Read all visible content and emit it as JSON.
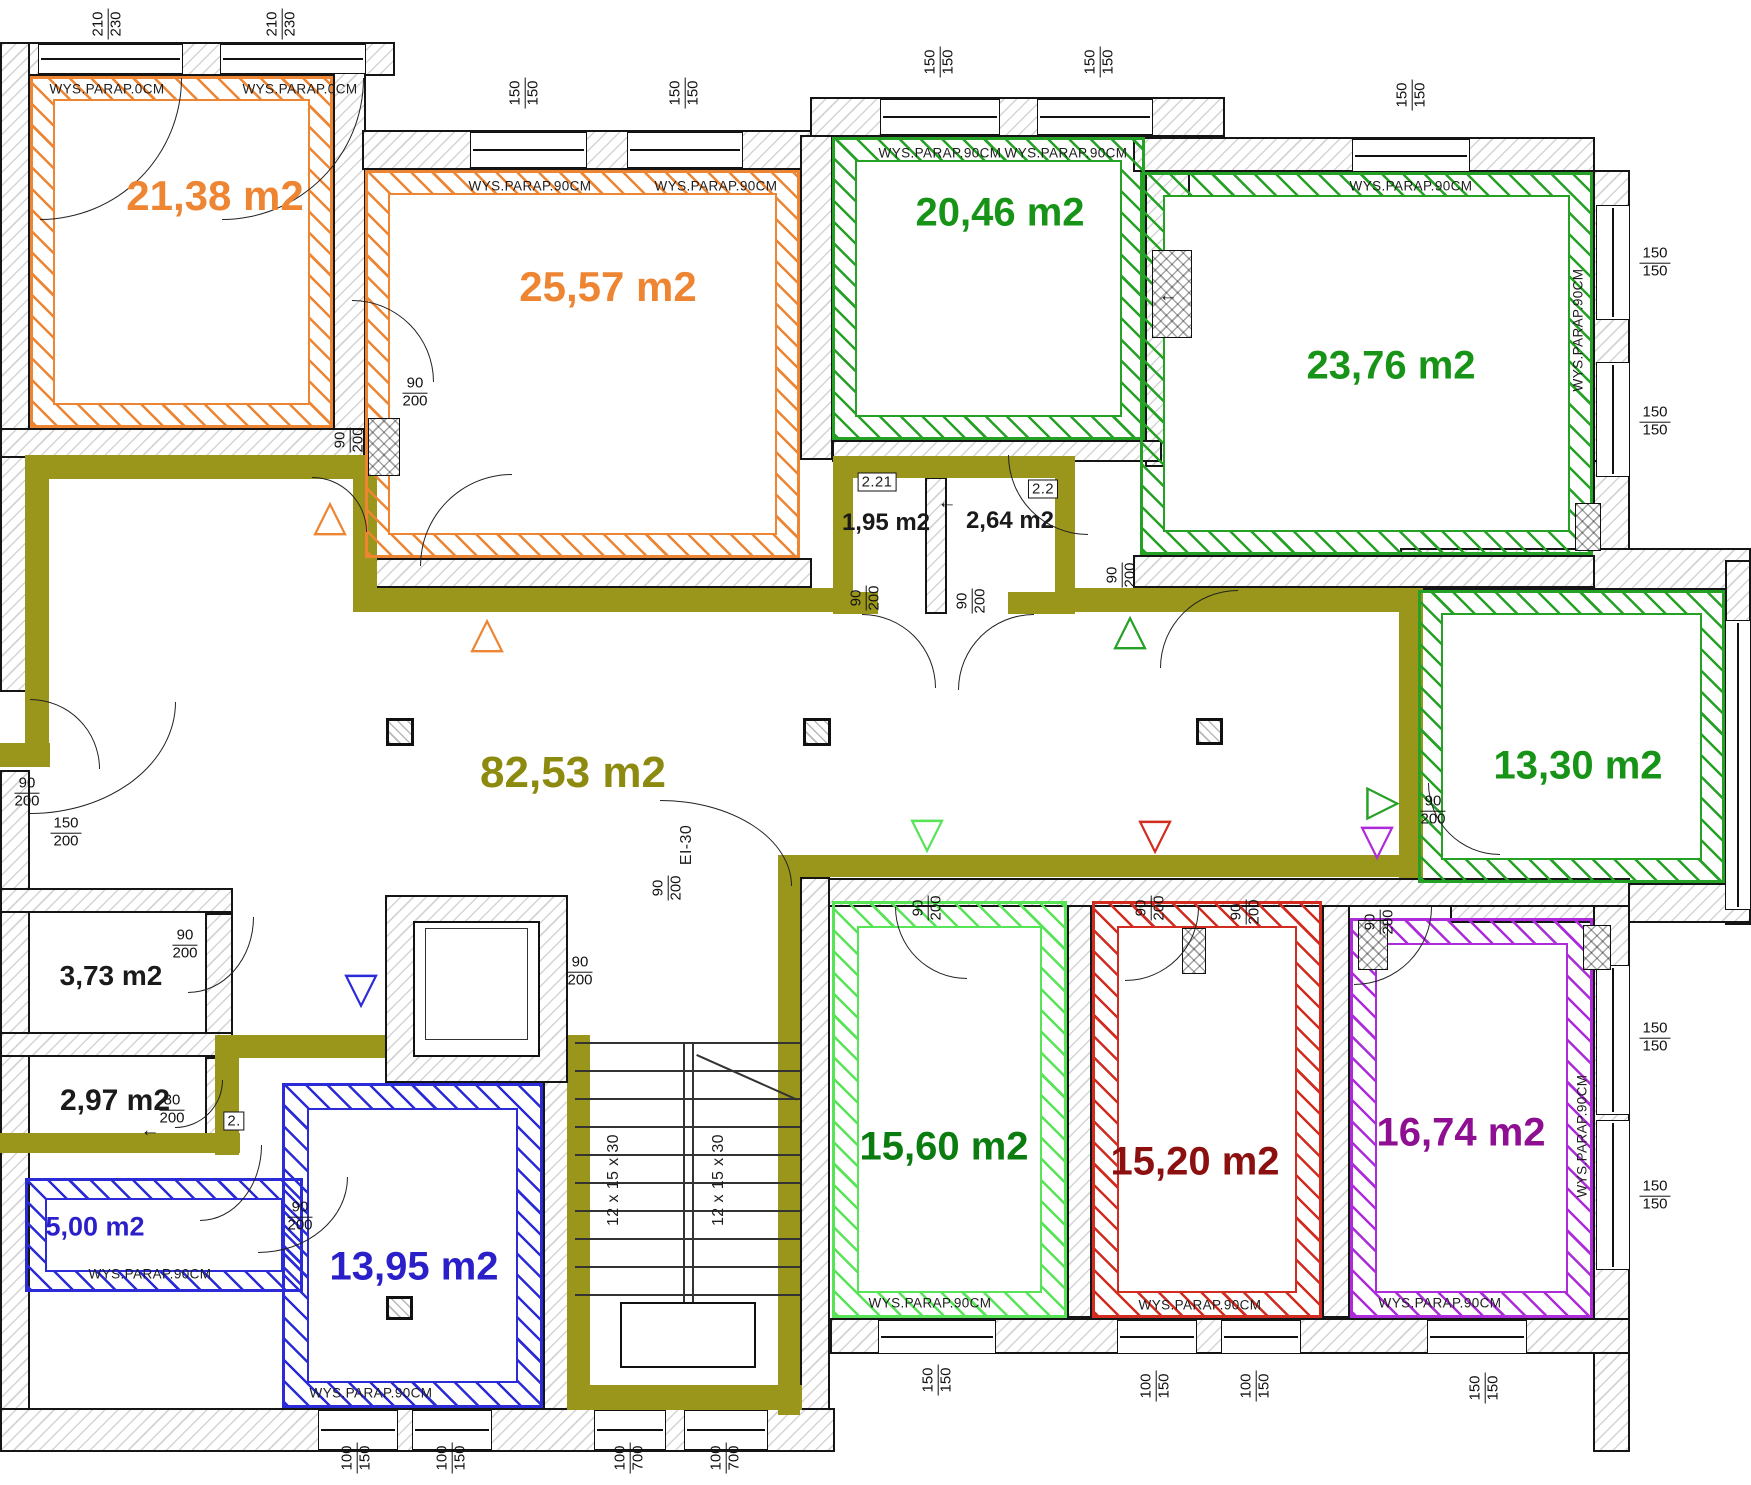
{
  "drawing": {
    "type": "architectural floor plan",
    "units": "m2 / cm"
  },
  "colors": {
    "orange": "#ED8533",
    "green": "#25A125",
    "green_text": "#179417",
    "olive": "#9A951B",
    "olive_text": "#8D8A10",
    "lgreen": "#57E457",
    "dgreen": "#0B7D10",
    "red": "#D22B20",
    "dred": "#8C1010",
    "purple": "#AD2BDB",
    "dpurple": "#8E0F92",
    "blue": "#2B2BD8",
    "blue_text": "#2A1FC9",
    "ink": "#1A1A1A"
  },
  "area_labels": [
    {
      "text": "21,38 m2",
      "x": 215,
      "y": 196,
      "s": 42,
      "c": "#ED8533"
    },
    {
      "text": "25,57 m2",
      "x": 608,
      "y": 287,
      "s": 42,
      "c": "#ED8533"
    },
    {
      "text": "20,46 m2",
      "x": 1000,
      "y": 213,
      "s": 40,
      "c": "#179417"
    },
    {
      "text": "23,76 m2",
      "x": 1391,
      "y": 366,
      "s": 40,
      "c": "#179417"
    },
    {
      "text": "13,30 m2",
      "x": 1578,
      "y": 766,
      "s": 40,
      "c": "#179417"
    },
    {
      "text": "82,53 m2",
      "x": 573,
      "y": 773,
      "s": 44,
      "c": "#8D8A10"
    },
    {
      "text": "1,95 m2",
      "x": 886,
      "y": 523,
      "s": 24,
      "c": "#1A1A1A"
    },
    {
      "text": "2,64 m2",
      "x": 1010,
      "y": 521,
      "s": 24,
      "c": "#1A1A1A"
    },
    {
      "text": "3,73 m2",
      "x": 111,
      "y": 976,
      "s": 28,
      "c": "#1A1A1A"
    },
    {
      "text": "2,97 m2",
      "x": 115,
      "y": 1101,
      "s": 30,
      "c": "#1A1A1A"
    },
    {
      "text": "5,00 m2",
      "x": 95,
      "y": 1227,
      "s": 27,
      "c": "#2A1FC9"
    },
    {
      "text": "13,95 m2",
      "x": 414,
      "y": 1267,
      "s": 40,
      "c": "#2A1FC9"
    },
    {
      "text": "15,60 m2",
      "x": 944,
      "y": 1147,
      "s": 40,
      "c": "#0B7D10"
    },
    {
      "text": "15,20 m2",
      "x": 1195,
      "y": 1162,
      "s": 40,
      "c": "#8C1010"
    },
    {
      "text": "16,74 m2",
      "x": 1461,
      "y": 1133,
      "s": 40,
      "c": "#8E0F92"
    }
  ],
  "rooms": [
    {
      "n": "room-21-38",
      "x": 30,
      "y": 76,
      "w": 303,
      "h": 352,
      "c": "#ED8533",
      "b": 20
    },
    {
      "n": "room-25-57",
      "x": 365,
      "y": 170,
      "w": 435,
      "h": 388,
      "c": "#ED8533",
      "b": 20
    },
    {
      "n": "room-20-46",
      "x": 832,
      "y": 137,
      "w": 313,
      "h": 303,
      "c": "#25A125",
      "b": 20
    },
    {
      "n": "room-23-76",
      "x": 1140,
      "y": 172,
      "w": 453,
      "h": 383,
      "c": "#25A125",
      "b": 20
    },
    {
      "n": "room-13-30",
      "x": 1418,
      "y": 590,
      "w": 307,
      "h": 293,
      "c": "#25A125",
      "b": 20
    },
    {
      "n": "room-15-60",
      "x": 832,
      "y": 901,
      "w": 235,
      "h": 417,
      "c": "#57E457",
      "b": 22
    },
    {
      "n": "room-15-20",
      "x": 1092,
      "y": 901,
      "w": 230,
      "h": 417,
      "c": "#D22B20",
      "b": 22
    },
    {
      "n": "room-16-74",
      "x": 1350,
      "y": 918,
      "w": 243,
      "h": 400,
      "c": "#AD2BDB",
      "b": 22
    },
    {
      "n": "room-13-95",
      "x": 282,
      "y": 1083,
      "w": 261,
      "h": 325,
      "c": "#2B2BD8",
      "b": 22
    },
    {
      "n": "room-5-00",
      "x": 25,
      "y": 1178,
      "w": 278,
      "h": 114,
      "c": "#2B2BD8",
      "b": 17
    }
  ],
  "walls": [
    [
      0,
      42,
      395,
      34
    ],
    [
      0,
      42,
      30,
      650
    ],
    [
      0,
      770,
      30,
      682
    ],
    [
      333,
      42,
      33,
      395
    ],
    [
      0,
      428,
      365,
      30
    ],
    [
      362,
      130,
      450,
      40
    ],
    [
      800,
      135,
      33,
      325
    ],
    [
      810,
      97,
      415,
      40
    ],
    [
      1145,
      137,
      45,
      330
    ],
    [
      1133,
      137,
      462,
      35
    ],
    [
      1593,
      170,
      37,
      295
    ],
    [
      1593,
      460,
      37,
      95
    ],
    [
      1400,
      548,
      351,
      42
    ],
    [
      1725,
      560,
      26,
      365
    ],
    [
      1450,
      883,
      301,
      40
    ],
    [
      1593,
      905,
      37,
      547
    ],
    [
      0,
      1408,
      835,
      44
    ],
    [
      830,
      1318,
      800,
      36
    ],
    [
      812,
      878,
      818,
      29
    ],
    [
      0,
      888,
      233,
      25
    ],
    [
      205,
      913,
      28,
      122
    ],
    [
      0,
      1032,
      233,
      25
    ],
    [
      205,
      1057,
      28,
      78
    ],
    [
      543,
      1057,
      28,
      353
    ],
    [
      800,
      877,
      30,
      533
    ],
    [
      1067,
      905,
      25,
      413
    ],
    [
      1322,
      905,
      28,
      413
    ],
    [
      362,
      558,
      450,
      30
    ],
    [
      832,
      440,
      330,
      22
    ],
    [
      1133,
      555,
      462,
      33
    ],
    [
      925,
      477,
      22,
      137
    ],
    [
      385,
      895,
      183,
      188
    ]
  ],
  "olive_segments": [
    [
      25,
      455,
      352,
      24
    ],
    [
      25,
      455,
      24,
      300
    ],
    [
      0,
      743,
      50,
      24
    ],
    [
      353,
      478,
      24,
      114
    ],
    [
      353,
      588,
      482,
      24
    ],
    [
      833,
      456,
      242,
      22
    ],
    [
      833,
      456,
      20,
      158
    ],
    [
      1055,
      456,
      20,
      158
    ],
    [
      833,
      592,
      45,
      22
    ],
    [
      1008,
      592,
      67,
      22
    ],
    [
      1075,
      588,
      348,
      24
    ],
    [
      1399,
      588,
      24,
      290
    ],
    [
      800,
      855,
      623,
      22
    ],
    [
      778,
      855,
      22,
      560
    ],
    [
      567,
      1035,
      23,
      372
    ],
    [
      567,
      1385,
      235,
      25
    ],
    [
      237,
      1035,
      353,
      23
    ],
    [
      215,
      1035,
      24,
      120
    ],
    [
      0,
      1133,
      240,
      20
    ]
  ],
  "windows": [
    {
      "x": 38,
      "y": 44,
      "w": 145,
      "h": 30,
      "o": "h"
    },
    {
      "x": 220,
      "y": 44,
      "w": 146,
      "h": 30,
      "o": "h"
    },
    {
      "x": 470,
      "y": 132,
      "w": 117,
      "h": 36,
      "o": "h"
    },
    {
      "x": 627,
      "y": 132,
      "w": 116,
      "h": 36,
      "o": "h"
    },
    {
      "x": 880,
      "y": 99,
      "w": 120,
      "h": 36,
      "o": "h"
    },
    {
      "x": 1037,
      "y": 99,
      "w": 116,
      "h": 36,
      "o": "h"
    },
    {
      "x": 1352,
      "y": 139,
      "w": 118,
      "h": 33,
      "o": "h"
    },
    {
      "x": 1596,
      "y": 205,
      "w": 34,
      "h": 115,
      "o": "v"
    },
    {
      "x": 1596,
      "y": 362,
      "w": 34,
      "h": 115,
      "o": "v"
    },
    {
      "x": 1725,
      "y": 620,
      "w": 26,
      "h": 290,
      "o": "v"
    },
    {
      "x": 1596,
      "y": 965,
      "w": 34,
      "h": 150,
      "o": "v"
    },
    {
      "x": 1596,
      "y": 1120,
      "w": 34,
      "h": 150,
      "o": "v"
    },
    {
      "x": 318,
      "y": 1410,
      "w": 80,
      "h": 40,
      "o": "h"
    },
    {
      "x": 412,
      "y": 1410,
      "w": 80,
      "h": 40,
      "o": "h"
    },
    {
      "x": 594,
      "y": 1410,
      "w": 72,
      "h": 40,
      "o": "h"
    },
    {
      "x": 684,
      "y": 1410,
      "w": 84,
      "h": 40,
      "o": "h"
    },
    {
      "x": 878,
      "y": 1320,
      "w": 118,
      "h": 34,
      "o": "h"
    },
    {
      "x": 1117,
      "y": 1320,
      "w": 80,
      "h": 34,
      "o": "h"
    },
    {
      "x": 1221,
      "y": 1320,
      "w": 80,
      "h": 34,
      "o": "h"
    },
    {
      "x": 1427,
      "y": 1320,
      "w": 100,
      "h": 34,
      "o": "h"
    }
  ],
  "dims": [
    {
      "a": "210",
      "b": "230",
      "x": 108,
      "y": 24,
      "rot": true
    },
    {
      "a": "210",
      "b": "230",
      "x": 282,
      "y": 24,
      "rot": true
    },
    {
      "a": "150",
      "b": "150",
      "x": 525,
      "y": 93,
      "rot": true
    },
    {
      "a": "150",
      "b": "150",
      "x": 685,
      "y": 93,
      "rot": true
    },
    {
      "a": "150",
      "b": "150",
      "x": 940,
      "y": 62,
      "rot": true
    },
    {
      "a": "150",
      "b": "150",
      "x": 1100,
      "y": 62,
      "rot": true
    },
    {
      "a": "150",
      "b": "150",
      "x": 1412,
      "y": 95,
      "rot": true
    },
    {
      "a": "150",
      "b": "150",
      "x": 1655,
      "y": 263
    },
    {
      "a": "150",
      "b": "150",
      "x": 1655,
      "y": 422
    },
    {
      "a": "150",
      "b": "150",
      "x": 1655,
      "y": 1038
    },
    {
      "a": "150",
      "b": "150",
      "x": 1655,
      "y": 1196
    },
    {
      "a": "100",
      "b": "150",
      "x": 357,
      "y": 1458,
      "rot": true
    },
    {
      "a": "100",
      "b": "150",
      "x": 452,
      "y": 1458,
      "rot": true
    },
    {
      "a": "100",
      "b": "700",
      "x": 630,
      "y": 1458,
      "rot": true
    },
    {
      "a": "100",
      "b": "700",
      "x": 726,
      "y": 1458,
      "rot": true
    },
    {
      "a": "150",
      "b": "150",
      "x": 938,
      "y": 1380,
      "rot": true
    },
    {
      "a": "100",
      "b": "150",
      "x": 1156,
      "y": 1386,
      "rot": true
    },
    {
      "a": "100",
      "b": "150",
      "x": 1256,
      "y": 1386,
      "rot": true
    },
    {
      "a": "150",
      "b": "150",
      "x": 1485,
      "y": 1388,
      "rot": true
    },
    {
      "a": "90",
      "b": "200",
      "x": 415,
      "y": 393
    },
    {
      "a": "90",
      "b": "200",
      "x": 350,
      "y": 440,
      "rot": true
    },
    {
      "a": "90",
      "b": "200",
      "x": 866,
      "y": 598,
      "rot": true
    },
    {
      "a": "90",
      "b": "200",
      "x": 972,
      "y": 601,
      "rot": true
    },
    {
      "a": "90",
      "b": "200",
      "x": 1122,
      "y": 575,
      "rot": true
    },
    {
      "a": "90",
      "b": "200",
      "x": 27,
      "y": 793
    },
    {
      "a": "150",
      "b": "200",
      "x": 66,
      "y": 833
    },
    {
      "a": "90",
      "b": "200",
      "x": 580,
      "y": 972
    },
    {
      "a": "90",
      "b": "200",
      "x": 668,
      "y": 888,
      "rot": true
    },
    {
      "a": "90",
      "b": "200",
      "x": 185,
      "y": 945
    },
    {
      "a": "80",
      "b": "200",
      "x": 172,
      "y": 1110
    },
    {
      "a": "90",
      "b": "200",
      "x": 300,
      "y": 1217
    },
    {
      "a": "90",
      "b": "200",
      "x": 928,
      "y": 908,
      "rot": true
    },
    {
      "a": "90",
      "b": "200",
      "x": 1151,
      "y": 908,
      "rot": true
    },
    {
      "a": "90",
      "b": "200",
      "x": 1380,
      "y": 922,
      "rot": true
    },
    {
      "a": "90",
      "b": "200",
      "x": 1433,
      "y": 811
    },
    {
      "a": "90",
      "b": "200",
      "x": 1246,
      "y": 912,
      "rot": true
    }
  ],
  "texts": [
    {
      "t": "WYS.PARAP.0CM",
      "x": 107,
      "y": 89
    },
    {
      "t": "WYS.PARAP.0CM",
      "x": 300,
      "y": 89
    },
    {
      "t": "WYS.PARAP.90CM",
      "x": 530,
      "y": 186
    },
    {
      "t": "WYS.PARAP.90CM",
      "x": 716,
      "y": 186
    },
    {
      "t": "WYS.PARAP.90CM",
      "x": 940,
      "y": 153
    },
    {
      "t": "WYS.PARAP.90CM",
      "x": 1066,
      "y": 153
    },
    {
      "t": "WYS.PARAP.90CM",
      "x": 1411,
      "y": 186
    },
    {
      "t": "WYS.PARAP.90CM",
      "x": 1578,
      "y": 330,
      "rot": true
    },
    {
      "t": "WYS.PARAP.90CM",
      "x": 1582,
      "y": 1136,
      "rot": true
    },
    {
      "t": "WYS.PARAP.90CM",
      "x": 930,
      "y": 1303
    },
    {
      "t": "WYS.PARAP.90CM",
      "x": 1200,
      "y": 1305
    },
    {
      "t": "WYS.PARAP.90CM",
      "x": 1440,
      "y": 1303
    },
    {
      "t": "WYS.PARAP.90CM",
      "x": 371,
      "y": 1393
    },
    {
      "t": "WYS.PARAP.90CM",
      "x": 150,
      "y": 1274
    },
    {
      "t": "12 x 15 x 30",
      "x": 614,
      "y": 1180,
      "rot": true,
      "s": 16
    },
    {
      "t": "12 x 15 x 30",
      "x": 719,
      "y": 1180,
      "rot": true,
      "s": 16
    },
    {
      "t": "EI-30",
      "x": 687,
      "y": 845,
      "rot": true,
      "s": 16
    }
  ],
  "room_tags": [
    {
      "t": "2.21",
      "x": 877,
      "y": 482
    },
    {
      "t": "2.2",
      "x": 1043,
      "y": 489
    },
    {
      "t": "2.",
      "x": 234,
      "y": 1121
    }
  ],
  "triangles": [
    {
      "g": "up",
      "x": 330,
      "y": 516,
      "c": "#ED8533"
    },
    {
      "g": "up",
      "x": 487,
      "y": 633,
      "c": "#ED8533"
    },
    {
      "g": "up",
      "x": 1130,
      "y": 630,
      "c": "#25A125"
    },
    {
      "g": "down",
      "x": 927,
      "y": 834,
      "c": "#57E457"
    },
    {
      "g": "down",
      "x": 1155,
      "y": 835,
      "c": "#D22B20"
    },
    {
      "g": "down",
      "x": 1377,
      "y": 841,
      "c": "#AD2BDB"
    },
    {
      "g": "right",
      "x": 1383,
      "y": 801,
      "c": "#25A125"
    },
    {
      "g": "down",
      "x": 361,
      "y": 989,
      "c": "#2B2BD8"
    }
  ],
  "arrows": [
    {
      "t": "←",
      "x": 947,
      "y": 503
    },
    {
      "t": "←",
      "x": 1168,
      "y": 296
    },
    {
      "t": "←",
      "x": 150,
      "y": 1131
    }
  ],
  "columns": [
    [
      386,
      718,
      28,
      28
    ],
    [
      803,
      718,
      28,
      28
    ],
    [
      1196,
      718,
      27,
      27
    ],
    [
      386,
      1296,
      27,
      24
    ]
  ],
  "shafts": [
    [
      368,
      418,
      32,
      58
    ],
    [
      1152,
      250,
      40,
      88
    ],
    [
      1575,
      503,
      26,
      48
    ],
    [
      1583,
      925,
      28,
      45
    ],
    [
      1182,
      928,
      24,
      46
    ],
    [
      1358,
      920,
      30,
      50
    ]
  ],
  "arcs": [
    {
      "x": 40,
      "y": 78,
      "w": 142,
      "h": 142,
      "k": "br"
    },
    {
      "x": 222,
      "y": 78,
      "w": 142,
      "h": 142,
      "k": "br"
    },
    {
      "x": 352,
      "y": 300,
      "w": 82,
      "h": 82,
      "k": "tr"
    },
    {
      "x": 420,
      "y": 474,
      "w": 92,
      "h": 92,
      "k": "tl"
    },
    {
      "x": 312,
      "y": 477,
      "w": 55,
      "h": 55,
      "k": "tr"
    },
    {
      "x": 862,
      "y": 614,
      "w": 74,
      "h": 74,
      "k": "tr"
    },
    {
      "x": 958,
      "y": 614,
      "w": 76,
      "h": 76,
      "k": "tl"
    },
    {
      "x": 1008,
      "y": 455,
      "w": 80,
      "h": 80,
      "k": "bl"
    },
    {
      "x": 1160,
      "y": 590,
      "w": 78,
      "h": 78,
      "k": "tl"
    },
    {
      "x": 660,
      "y": 800,
      "w": 132,
      "h": 86,
      "k": "tr"
    },
    {
      "x": 188,
      "y": 917,
      "w": 66,
      "h": 76,
      "k": "br"
    },
    {
      "x": 175,
      "y": 1080,
      "w": 48,
      "h": 48,
      "k": "br"
    },
    {
      "x": 200,
      "y": 1145,
      "w": 62,
      "h": 76,
      "k": "br"
    },
    {
      "x": 258,
      "y": 1177,
      "w": 90,
      "h": 76,
      "k": "br"
    },
    {
      "x": 895,
      "y": 907,
      "w": 72,
      "h": 72,
      "k": "bl"
    },
    {
      "x": 1125,
      "y": 907,
      "w": 74,
      "h": 74,
      "k": "br"
    },
    {
      "x": 1354,
      "y": 907,
      "w": 78,
      "h": 78,
      "k": "br"
    },
    {
      "x": 1428,
      "y": 783,
      "w": 72,
      "h": 72,
      "k": "bl"
    },
    {
      "x": 30,
      "y": 699,
      "w": 70,
      "h": 70,
      "k": "tr"
    },
    {
      "x": 30,
      "y": 702,
      "w": 146,
      "h": 112,
      "k": "br"
    }
  ],
  "stairs": {
    "x": 575,
    "y": 1042,
    "w": 225,
    "h": 252,
    "treads": 10,
    "divider_x": 683,
    "label": "12 x 15 x 30",
    "landing": [
      620,
      1302,
      136,
      66
    ]
  },
  "elevator": {
    "outer": [
      385,
      895,
      183,
      188
    ],
    "cab": [
      413,
      921,
      127,
      136
    ],
    "inner": [
      425,
      928,
      103,
      112
    ]
  }
}
